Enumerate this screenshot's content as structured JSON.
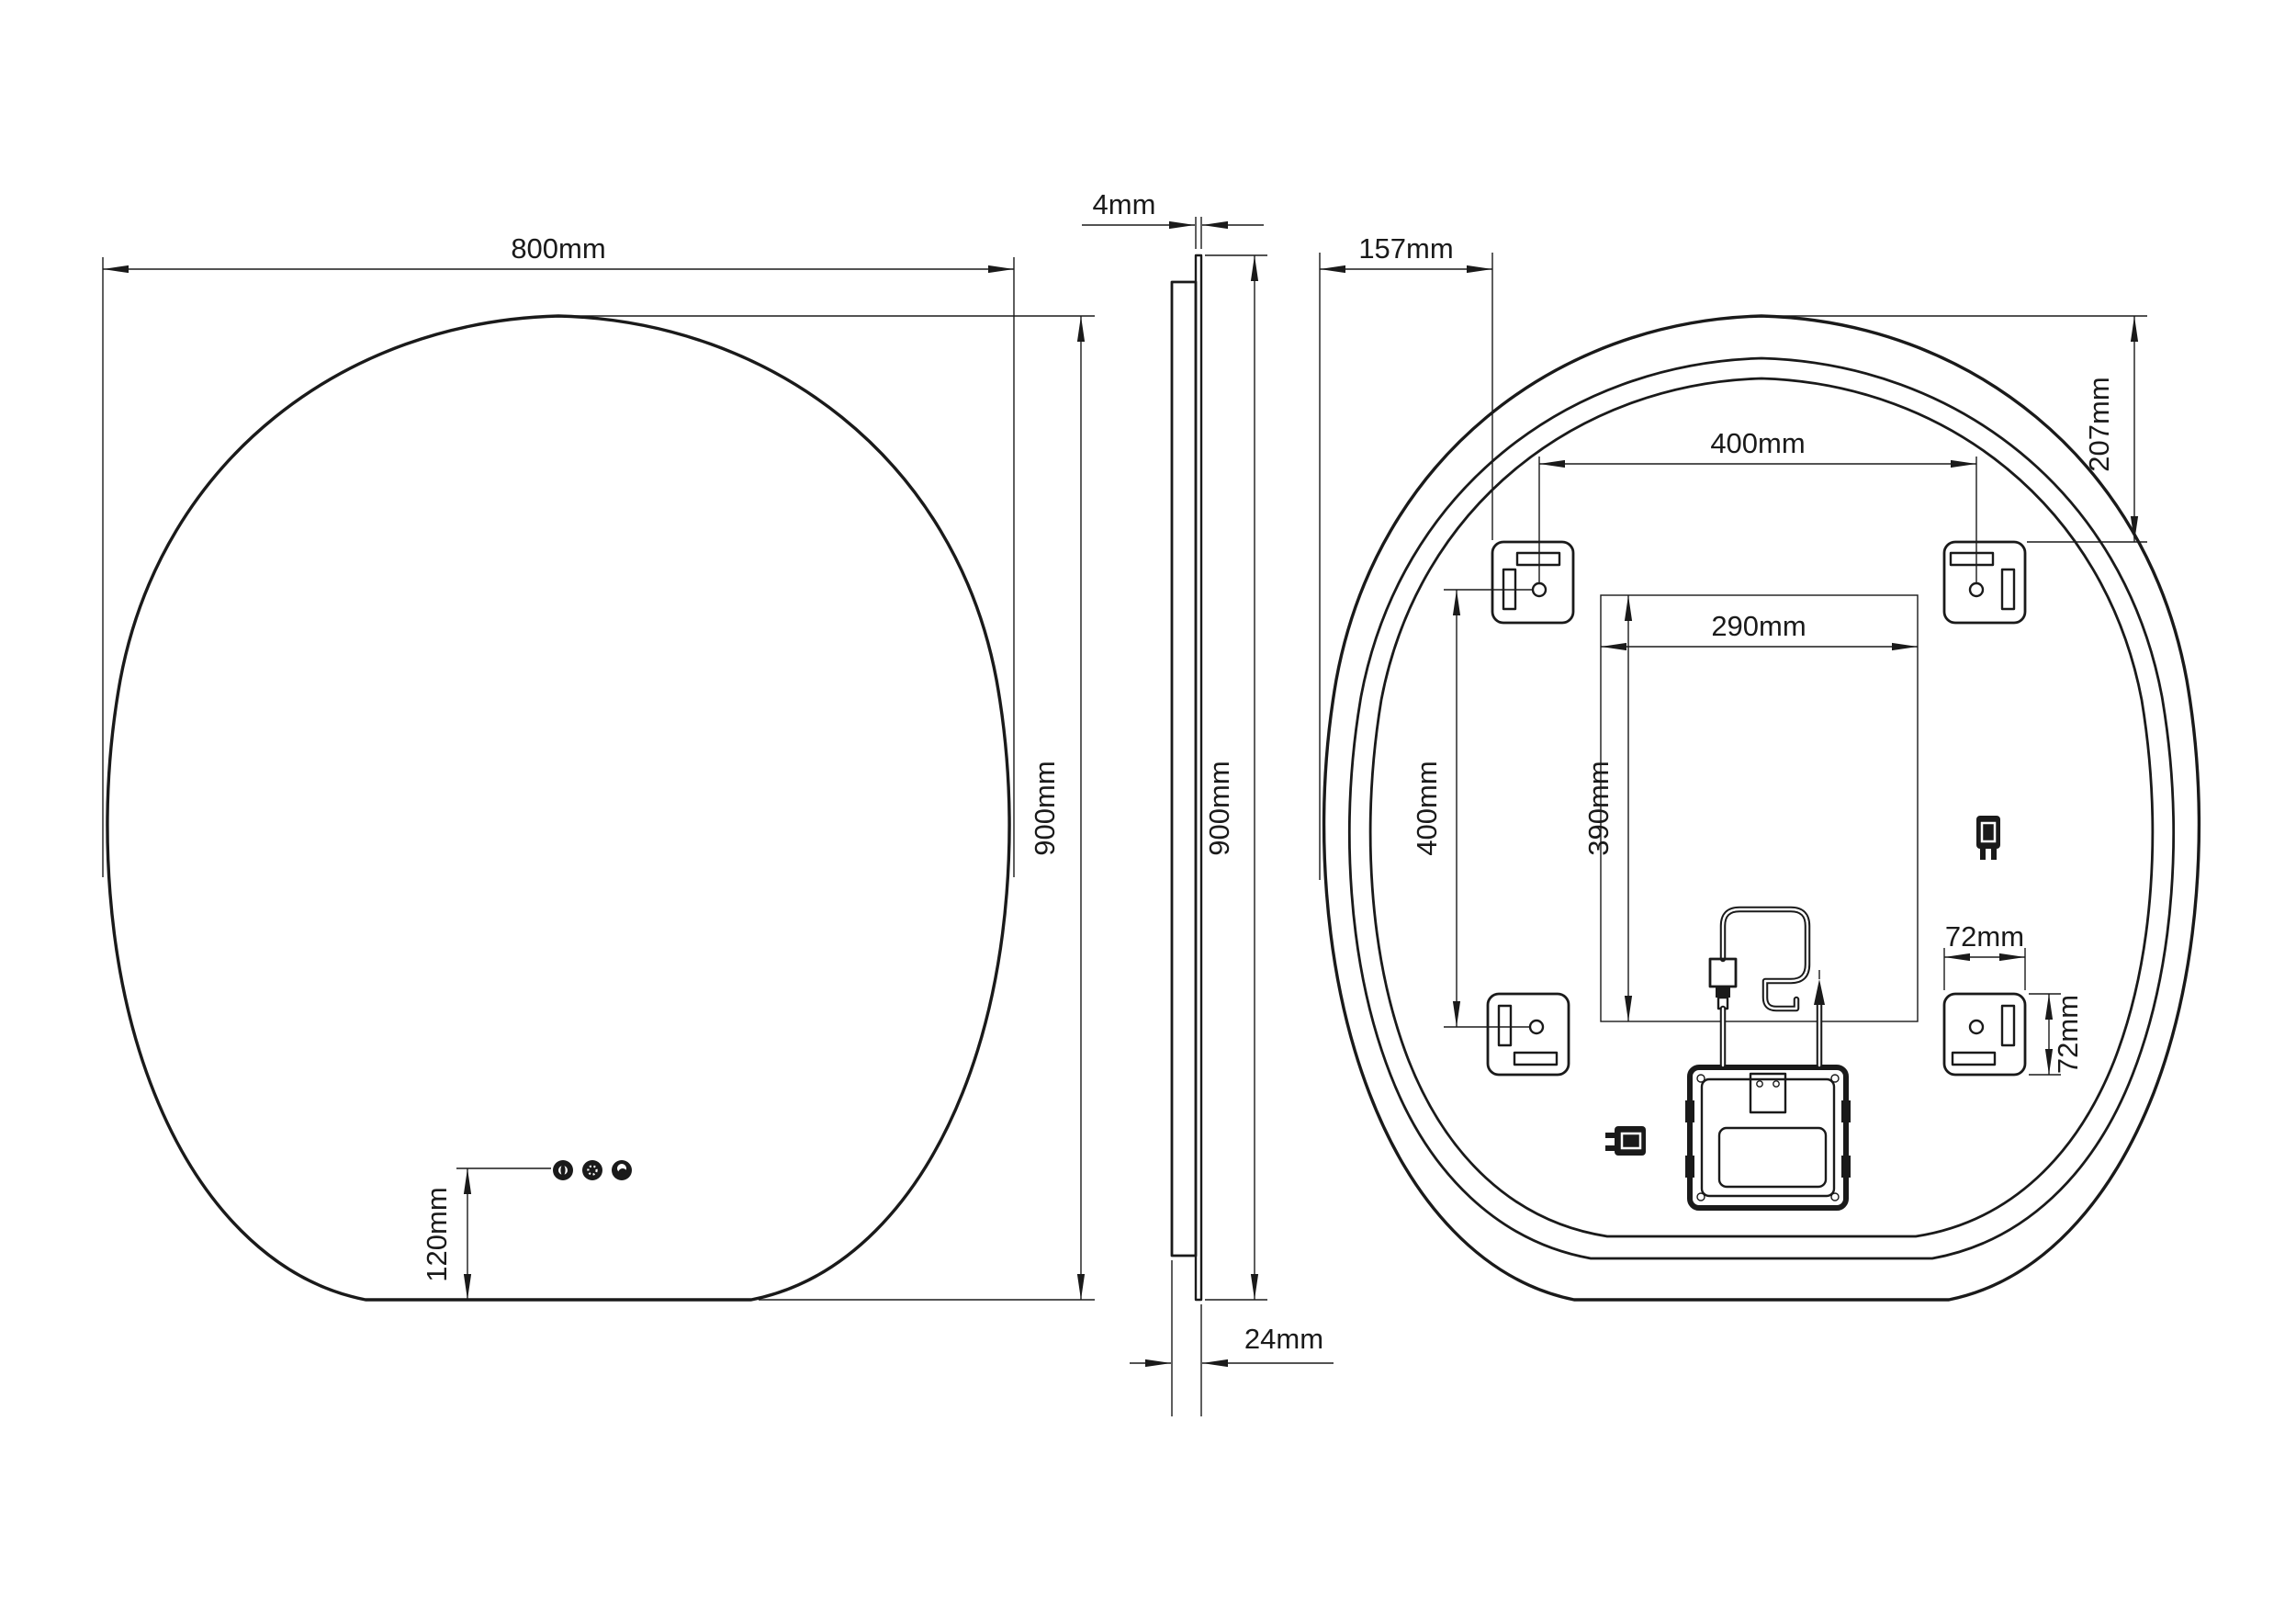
{
  "colors": {
    "background": "#ffffff",
    "line": "#1a1a1a"
  },
  "front_view": {
    "width_label": "800mm",
    "height_label": "900mm",
    "button_offset_label": "120mm",
    "icons": [
      "power-button-icon",
      "dimmer-button-icon",
      "moon-button-icon"
    ]
  },
  "side_view": {
    "glass_thickness_label": "4mm",
    "height_label": "900mm",
    "depth_label": "24mm"
  },
  "back_view": {
    "side_offset_label": "157mm",
    "top_offset_label": "207mm",
    "bracket_spacing_horizontal_label": "400mm",
    "bracket_spacing_vertical_label": "400mm",
    "clearance_width_label": "290mm",
    "clearance_height_label": "390mm",
    "bracket_width_label": "72mm",
    "bracket_height_label": "72mm",
    "icons": [
      "mounting-bracket-icon",
      "junction-box-icon",
      "power-cable-coil-icon",
      "plug-icon",
      "connector-icon"
    ]
  }
}
